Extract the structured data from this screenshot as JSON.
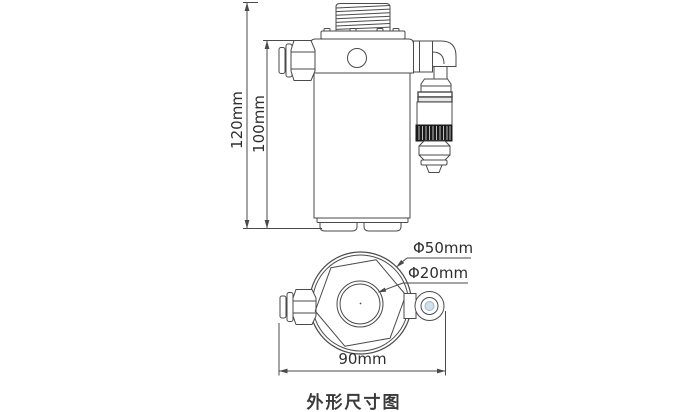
{
  "caption": "外形尺寸图",
  "dimensions": {
    "total_height": "120mm",
    "body_height": "100mm",
    "outer_diameter": "Φ50mm",
    "port_diameter": "Φ20mm",
    "overall_width": "90mm"
  },
  "colors": {
    "line": "#4a4a4a",
    "text": "#2e2e2e",
    "knurl_dark": "#1a1a1a",
    "fitting_bore_blue": "#cfe2ec",
    "background": "#ffffff"
  }
}
